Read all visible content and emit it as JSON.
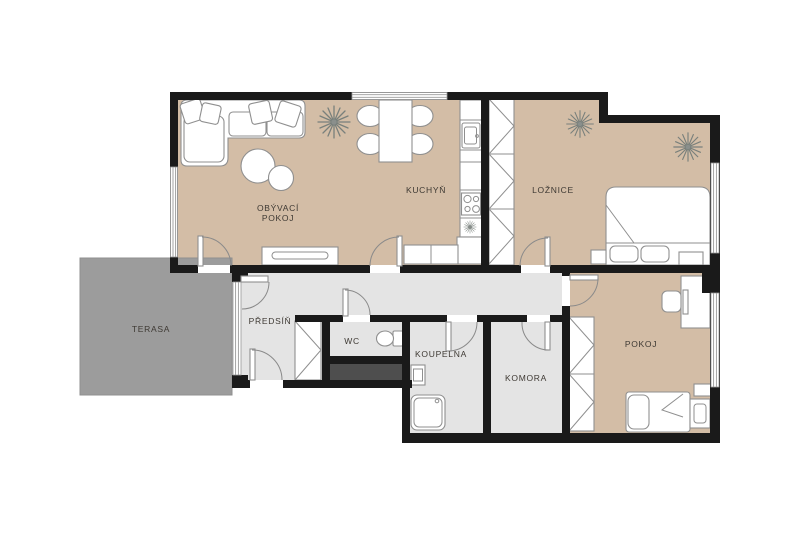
{
  "plan": {
    "type": "apartment-floor-plan",
    "language": "cs"
  },
  "colors": {
    "wall": "#1a1a1a",
    "floor-warm": "#d3bda6",
    "floor-cool": "#e4e4e4",
    "terrace": "#9c9c9c",
    "shaft": "#4e4e4e",
    "furniture-stroke": "#8f8f8f",
    "label": "#3e3933",
    "window-line": "#9a9a9a",
    "background": "#ffffff"
  },
  "rooms": [
    {
      "id": "obyvaci-pokoj",
      "label_line1": "OBÝVACÍ",
      "label_line2": "POKOJ"
    },
    {
      "id": "kuchyn",
      "label": "KUCHYŇ"
    },
    {
      "id": "loznice",
      "label": "LOŽNICE"
    },
    {
      "id": "terasa",
      "label": "TERASA"
    },
    {
      "id": "predsin",
      "label": "PŘEDSÍŇ"
    },
    {
      "id": "wc",
      "label": "WC"
    },
    {
      "id": "koupelna",
      "label": "KOUPELNA"
    },
    {
      "id": "komora",
      "label": "KOMORA"
    },
    {
      "id": "pokoj",
      "label": "POKOJ"
    }
  ],
  "furniture": {
    "obyvaci_pokoj": [
      "corner-sofa",
      "throw-pillows",
      "coffee-table",
      "sideboard",
      "plant"
    ],
    "kuchyn": [
      "dining-table",
      "four-chairs",
      "kitchen-counter",
      "sink",
      "cooktop",
      "tall-cabinet",
      "fridge-snowflake"
    ],
    "loznice": [
      "wardrobe",
      "double-bed",
      "two-pillows",
      "nightstand",
      "bench",
      "plant",
      "plant"
    ],
    "predsin": [
      "wardrobe"
    ],
    "wc": [
      "toilet"
    ],
    "koupelna": [
      "washbasin",
      "shower"
    ],
    "pokoj": [
      "wardrobe",
      "desk",
      "office-chair",
      "monitor",
      "single-bed",
      "pillow",
      "nightstand",
      "radiator"
    ]
  },
  "windows": [
    "living-room-top",
    "living-room-left",
    "hall-terrace-glazing",
    "bedroom-right",
    "pokoj-right"
  ],
  "doors": [
    "living-room",
    "kitchen",
    "bedroom",
    "wc",
    "bathroom",
    "storage-room",
    "pokoj",
    "terrace",
    "entrance"
  ]
}
